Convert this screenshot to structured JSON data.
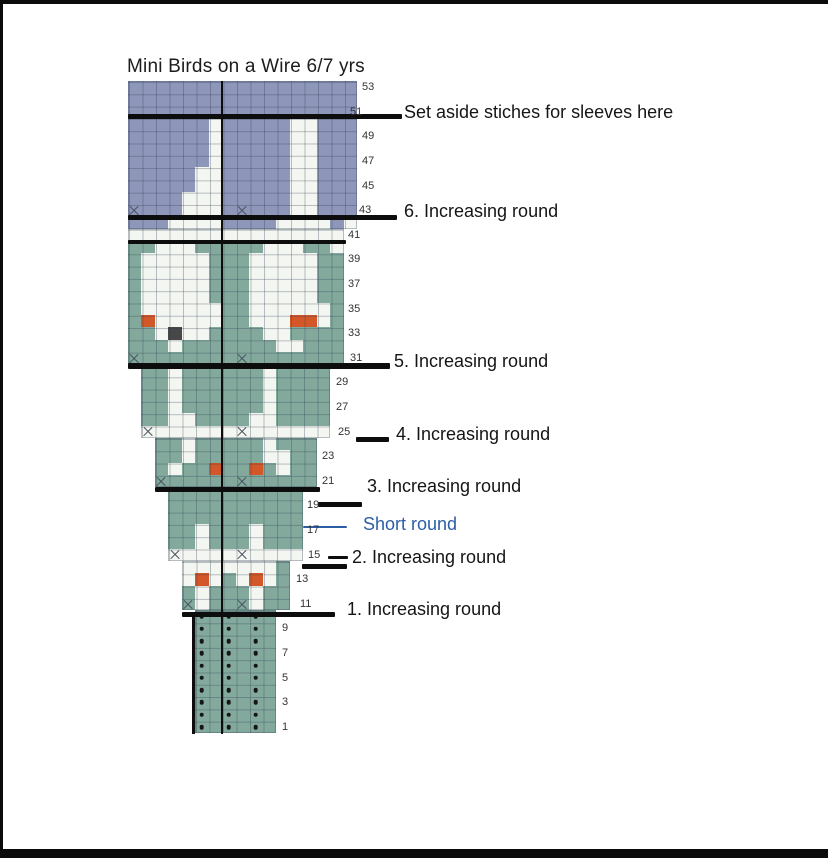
{
  "title": "Mini Birds on a Wire 6/7 yrs",
  "palette": {
    "B": "#8e97ba",
    "G": "#83a99d",
    "W": "#f3f6f1",
    "O": "#d2582a",
    "D": "#474747",
    "wire_black": "#0d0d0d",
    "short_round_blue": "#2b5ea7",
    "grid_line": "rgba(40,55,75,0.30)",
    "row_label_color": "#333333"
  },
  "frame": {
    "top_bar": {
      "x": 0,
      "y": 0,
      "w": 828,
      "h": 4
    },
    "left_bar": {
      "x": 0,
      "y": 0,
      "w": 3,
      "h": 849
    },
    "bottom_bar": {
      "x": 0,
      "y": 849,
      "w": 828,
      "h": 9
    }
  },
  "grid": {
    "origin_x": 127.5,
    "cell_w": 13.5,
    "cell_h": 12.3,
    "row1_top_y": 720.9,
    "center_line": {
      "x": 220.9,
      "w": 2.6,
      "y1": 81,
      "y2": 734
    },
    "ribbing_left_line": {
      "x": 192,
      "w": 2.5,
      "y1": 612,
      "y2": 734
    }
  },
  "chart_data": {
    "type": "knitting-colorwork-chart",
    "legend": {
      "B": "sleeve/yoke top main color (blue-purple)",
      "G": "body main color (sage green)",
      "W": "bird motif (off-white)",
      "O": "beak (orange)",
      "D": "bird eye (dark gray)",
      "X": "increase stitch symbol on base color",
      "w": "increase stitch symbol on white row",
      ".": "purl stitch dot (ribbing)"
    },
    "sections": [
      {
        "name": "yoke-purple",
        "base": "B",
        "top_row": 53,
        "col_start": 0,
        "rows": [
          "BBBBBBBBBBBBBBBBB",
          "BBBBBBBBBBBBBBBBB",
          "BBBBBBBBBBBBBBBBB",
          "BBBBBBWBBBBBWWBBB",
          "BBBBBBWBBBBBWWBBB",
          "BBBBBBWBBBBBWWBBB",
          "BBBBBBWBBBBBWWBBB",
          "BBBBBWWBBBBBWWBBB",
          "BBBBBWWBBBBBWWBBB",
          "BBBBWWWBBBBBWWBBB",
          "XBBBWWWBXBBBWWBBB",
          "BBBWWWWBBBBWWWWBW"
        ]
      },
      {
        "name": "transition-white-row",
        "base": "W",
        "top_row": 41,
        "col_start": 0,
        "rows": [
          "WWWWWWWWWWWWWWWW"
        ]
      },
      {
        "name": "yoke-green-birds",
        "base": "G",
        "top_row": 40,
        "col_start": 0,
        "rows": [
          "GGWWWGGGGGWWWGGW",
          "GWWWWWGGGWWWWWGG",
          "GWWWWWGGGWWWWWGG",
          "GWWWWWGGGWWWWWGG",
          "GWWWWWGGGWWWWWGG",
          "GWWWWWWGGWWWWWWG",
          "GOWWWWWGGWWWOOWG",
          "GGWDWWGGGGWWGGGG",
          "GGGWGGGGGGGWWGGG",
          "XGGGGGGGXGGGGGGG"
        ]
      },
      {
        "name": "body-rows-30-25",
        "base": "G",
        "top_row": 30,
        "col_start": 1,
        "rows": [
          "GGWGGGGGGWGGGG",
          "GGWGGGGGGWGGGG",
          "GGWGGGGGGWGGGG",
          "GGWGGGGGGWGGGG",
          "GGWWGGGGWWGGGG",
          "wWWWWWWwWWWWWW"
        ]
      },
      {
        "name": "body-rows-24-21",
        "base": "G",
        "top_row": 24,
        "col_start": 2,
        "rows": [
          "GGWGGGGGWGGG",
          "GGWGGGGGWWGG",
          "GWGGOGGOGWGG",
          "XGGGGGXGGGGG"
        ]
      },
      {
        "name": "body-rows-20-15",
        "base": "G",
        "top_row": 20,
        "col_start": 3,
        "rows": [
          "GGGGGGGGGG",
          "GGGGGGGGGG",
          "GGGGGGGGGG",
          "GGWGGGWGGG",
          "GGWGGGWGGG",
          "wWWWWwWWWW"
        ]
      },
      {
        "name": "body-rows-14-11",
        "base": "G",
        "top_row": 14,
        "col_start": 4,
        "rows": [
          "WWWWWWWG",
          "WOWGWOWG",
          "GWGGGWGG",
          "XWGGXWGG"
        ]
      },
      {
        "name": "ribbing",
        "base": "G",
        "top_row": 10,
        "col_start": 5,
        "rows": [
          ".G.G.G",
          ".G.G.G",
          ".G.G.G",
          ".G.G.G",
          ".G.G.G",
          ".G.G.G",
          ".G.G.G",
          ".G.G.G",
          ".G.G.G",
          ".G.G.G"
        ]
      }
    ]
  },
  "wires": [
    {
      "x1": 127.5,
      "x2": 402,
      "y": 114,
      "h": 5,
      "color": "wire_black"
    },
    {
      "x1": 127.5,
      "x2": 397,
      "y": 214.5,
      "h": 5,
      "color": "wire_black"
    },
    {
      "x1": 127.5,
      "x2": 346,
      "y": 239.5,
      "h": 4.5,
      "color": "wire_black"
    },
    {
      "x1": 127.5,
      "x2": 390,
      "y": 363,
      "h": 5.5,
      "color": "wire_black"
    },
    {
      "x1": 356,
      "x2": 389,
      "y": 437,
      "h": 5,
      "color": "wire_black"
    },
    {
      "x1": 154.5,
      "x2": 320,
      "y": 487,
      "h": 5,
      "color": "wire_black"
    },
    {
      "x1": 318,
      "x2": 362,
      "y": 501.5,
      "h": 5,
      "color": "wire_black"
    },
    {
      "x1": 328,
      "x2": 348,
      "y": 555.5,
      "h": 3.5,
      "color": "wire_black"
    },
    {
      "x1": 302,
      "x2": 347,
      "y": 563.5,
      "h": 5,
      "color": "wire_black"
    },
    {
      "x1": 181.5,
      "x2": 335,
      "y": 611.5,
      "h": 5,
      "color": "wire_black"
    },
    {
      "x1": 303,
      "x2": 347,
      "y": 526,
      "h": 2.2,
      "color": "short_round_blue"
    }
  ],
  "annotations": [
    {
      "text": "Set aside stiches for sleeves here",
      "x": 404,
      "y": 102,
      "color": "#151515"
    },
    {
      "text": "6. Increasing round",
      "x": 404,
      "y": 201,
      "color": "#151515"
    },
    {
      "text": "5. Increasing round",
      "x": 394,
      "y": 350.5,
      "color": "#151515"
    },
    {
      "text": "4. Increasing round",
      "x": 396,
      "y": 423.5,
      "color": "#151515"
    },
    {
      "text": "3. Increasing round",
      "x": 367,
      "y": 476,
      "color": "#151515"
    },
    {
      "text": "Short round",
      "x": 363,
      "y": 513.5,
      "color": "#2b5ea7"
    },
    {
      "text": "2. Increasing round",
      "x": 352,
      "y": 547,
      "color": "#151515"
    },
    {
      "text": "1. Increasing round",
      "x": 347,
      "y": 598.5,
      "color": "#151515"
    }
  ],
  "row_labels": [
    {
      "row": 53,
      "x": 362
    },
    {
      "row": 51,
      "x": 350
    },
    {
      "row": 49,
      "x": 362
    },
    {
      "row": 47,
      "x": 362
    },
    {
      "row": 45,
      "x": 362
    },
    {
      "row": 43,
      "x": 359
    },
    {
      "row": 41,
      "x": 348
    },
    {
      "row": 39,
      "x": 348
    },
    {
      "row": 37,
      "x": 348
    },
    {
      "row": 35,
      "x": 348
    },
    {
      "row": 33,
      "x": 348
    },
    {
      "row": 31,
      "x": 350
    },
    {
      "row": 29,
      "x": 336
    },
    {
      "row": 27,
      "x": 336
    },
    {
      "row": 25,
      "x": 338
    },
    {
      "row": 23,
      "x": 322
    },
    {
      "row": 21,
      "x": 322
    },
    {
      "row": 19,
      "x": 307
    },
    {
      "row": 17,
      "x": 307
    },
    {
      "row": 15,
      "x": 308
    },
    {
      "row": 13,
      "x": 296
    },
    {
      "row": 11,
      "x": 300
    },
    {
      "row": 9,
      "x": 282
    },
    {
      "row": 7,
      "x": 282
    },
    {
      "row": 5,
      "x": 282
    },
    {
      "row": 3,
      "x": 282
    },
    {
      "row": 1,
      "x": 282
    }
  ]
}
